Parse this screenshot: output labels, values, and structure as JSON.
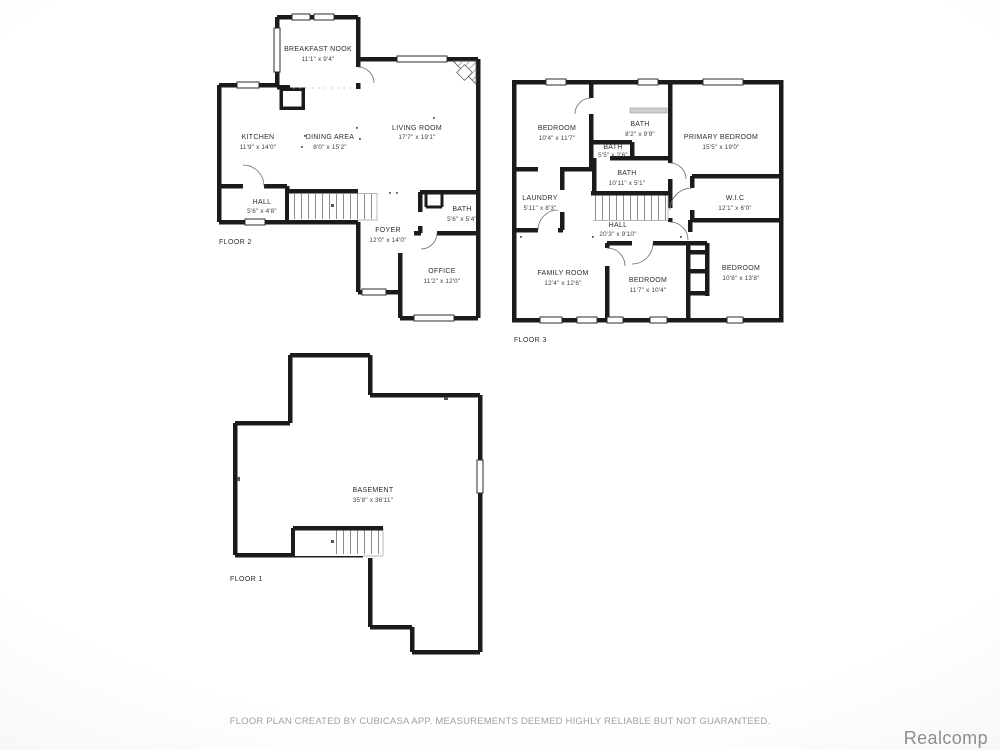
{
  "page": {
    "disclaimer": "FLOOR PLAN CREATED BY CUBICASA APP. MEASUREMENTS DEEMED HIGHLY RELIABLE BUT NOT GUARANTEED.",
    "watermark": "Realcomp"
  },
  "colors": {
    "wall": "#1b1b1b",
    "background_center": "#ffffff",
    "background_edge": "#ebebeb",
    "label_text": "#2c2c2c",
    "muted_text": "#a1a1a1",
    "watermark_text": "#8e8e8e",
    "stair_hatch": "#808080",
    "shower": "#cfcfcf"
  },
  "floors": {
    "floor2": {
      "label": "FLOOR 2",
      "rooms": {
        "breakfast_nook": {
          "name": "BREAKFAST NOOK",
          "dims": "11'1\" x 9'4\""
        },
        "kitchen": {
          "name": "KITCHEN",
          "dims": "11'9\" x 14'0\""
        },
        "dining_area": {
          "name": "DINING AREA",
          "dims": "8'0\" x 15'2\""
        },
        "living_room": {
          "name": "LIVING ROOM",
          "dims": "17'7\" x 19'1\""
        },
        "hall": {
          "name": "HALL",
          "dims": "5'6\" x 4'8\""
        },
        "foyer": {
          "name": "FOYER",
          "dims": "12'0\" x 14'0\""
        },
        "bath": {
          "name": "BATH",
          "dims": "5'6\" x 5'4\""
        },
        "office": {
          "name": "OFFICE",
          "dims": "11'2\" x 12'0\""
        }
      }
    },
    "floor3": {
      "label": "FLOOR 3",
      "rooms": {
        "bedroom_nw": {
          "name": "BEDROOM",
          "dims": "10'4\" x 11'7\""
        },
        "bath_main": {
          "name": "BATH",
          "dims": "8'2\" x 9'9\""
        },
        "primary_bedroom": {
          "name": "PRIMARY BEDROOM",
          "dims": "15'5\" x 19'0\""
        },
        "bath_small": {
          "name": "BATH",
          "dims": "5'5\" x 2'6\""
        },
        "bath_hall": {
          "name": "BATH",
          "dims": "10'11\" x 5'1\""
        },
        "laundry": {
          "name": "LAUNDRY",
          "dims": "5'11\" x 8'3\""
        },
        "wic": {
          "name": "W.I.C",
          "dims": "12'1\" x 6'0\""
        },
        "hall": {
          "name": "HALL",
          "dims": "20'3\" x 9'10\""
        },
        "family_room": {
          "name": "FAMILY ROOM",
          "dims": "12'4\" x 12'6\""
        },
        "bedroom_s": {
          "name": "BEDROOM",
          "dims": "11'7\" x 10'4\""
        },
        "bedroom_se": {
          "name": "BEDROOM",
          "dims": "10'8\" x 13'8\""
        }
      }
    },
    "floor1": {
      "label": "FLOOR 1",
      "rooms": {
        "basement": {
          "name": "BASEMENT",
          "dims": "35'8\" x 36'11\""
        }
      }
    }
  }
}
